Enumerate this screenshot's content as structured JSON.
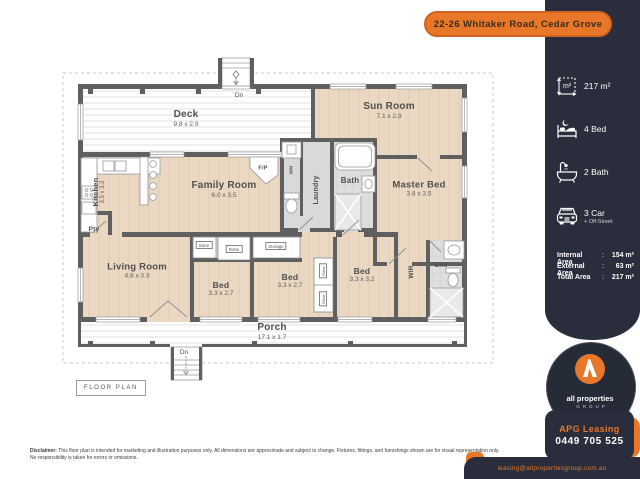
{
  "banner": {
    "address": "22-26 Whitaker Road, Cedar Grove"
  },
  "sidebar": {
    "stats": [
      {
        "icon": "area-icon",
        "label": "217 m²"
      },
      {
        "icon": "bed-icon",
        "label": "4 Bed"
      },
      {
        "icon": "bath-icon",
        "label": "2 Bath"
      },
      {
        "icon": "car-icon",
        "label": "3 Car",
        "sublabel": "+ Off-Street"
      }
    ],
    "areas_sep": ":",
    "areas": [
      {
        "label": "Internal Area",
        "value": "154 m²"
      },
      {
        "label": "External Area",
        "value": "63 m²"
      },
      {
        "label": "Total Area",
        "value": "217 m²"
      }
    ],
    "logo": {
      "name": "all properties",
      "group": "GROUP"
    },
    "contact": {
      "agency": "APG Leasing",
      "phone": "0449 705 525",
      "email": "leasing@allpropertiesgroup.com.au"
    }
  },
  "plan": {
    "tag": "FLOOR PLAN",
    "rooms": {
      "deck": {
        "name": "Deck",
        "dims": "9.8 x 2.9"
      },
      "sunroom": {
        "name": "Sun Room",
        "dims": "7.1 x 2.9"
      },
      "kitchen": {
        "name": "Kitchen",
        "dims": "3.5 x 3.2"
      },
      "family": {
        "name": "Family Room",
        "dims": "6.0 x 3.5"
      },
      "living": {
        "name": "Living Room",
        "dims": "4.8 x 3.3"
      },
      "master": {
        "name": "Master Bed",
        "dims": "3.8 x 3.5"
      },
      "bed2": {
        "name": "Bed",
        "dims": "3.3 x 2.7"
      },
      "bed3": {
        "name": "Bed",
        "dims": "3.3 x 2.7"
      },
      "bed4": {
        "name": "Bed",
        "dims": "3.3 x 3.2"
      },
      "porch": {
        "name": "Porch",
        "dims": "17.1 x 1.7"
      },
      "bath": {
        "name": "Bath"
      },
      "laundry": {
        "name": "Laundry"
      },
      "wm": {
        "name": "WM"
      },
      "wir": {
        "name": "WIR"
      },
      "ens": {
        "name": "Ens"
      },
      "pty": {
        "name": "Pty"
      },
      "fp": {
        "name": "F/P"
      },
      "store": {
        "name": "Store"
      },
      "storage": {
        "name": "Storage"
      },
      "robe": {
        "name": "Robe"
      },
      "dn": {
        "name": "Dn"
      }
    }
  },
  "disclaimer": {
    "bold": "Disclaimer:",
    "line1": " This floor plan is intended for marketing and illustration purposes only. All dimensions are approximate and subject to change. Fixtures, fittings, and furnishings shown are for visual representation only.",
    "line2": "No responsibility is taken for errors or omissions."
  },
  "colors": {
    "orange": "#E8772A",
    "navy": "#2A2E3C",
    "floor_tan": "#EAD8C3",
    "wall_gray": "#5F5F5F"
  }
}
